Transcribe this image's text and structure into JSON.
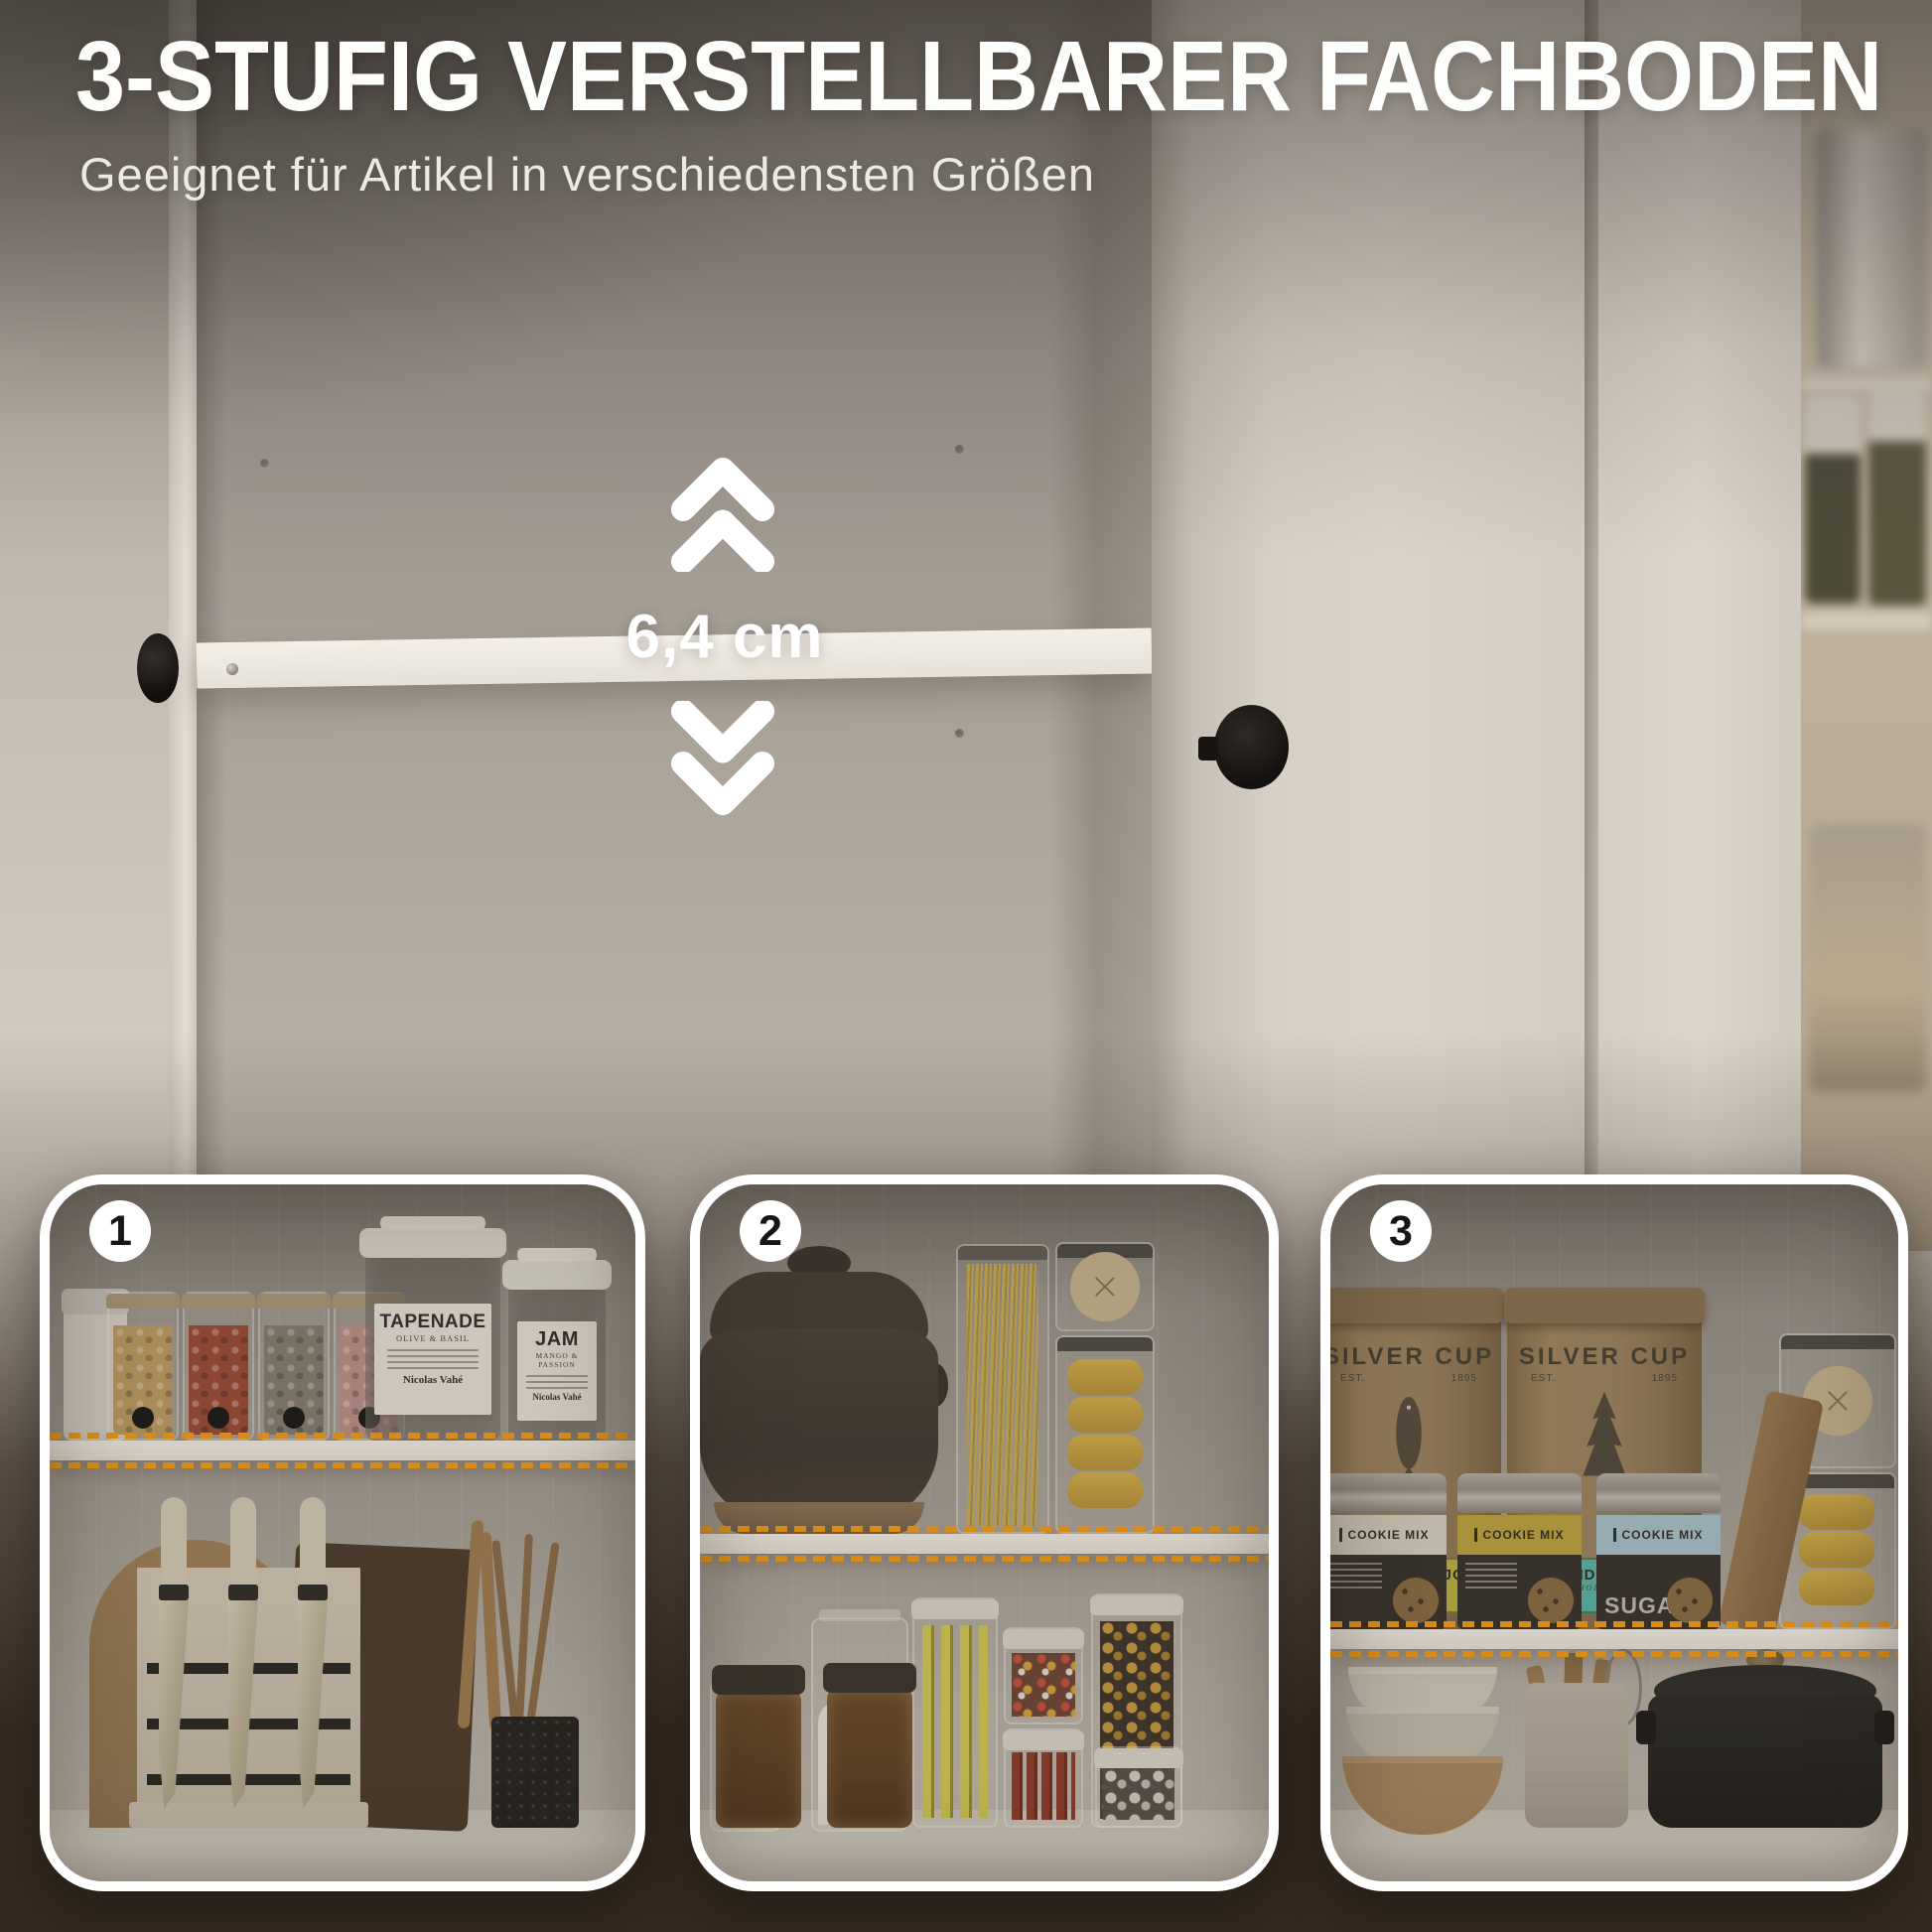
{
  "header": {
    "title": "3-STUFIG VERSTELLBARER FACHBODEN",
    "subtitle": "Geeignet für Artikel in verschiedensten Größen"
  },
  "measurement": {
    "label": "6,4 cm"
  },
  "panels": [
    {
      "number": "1",
      "jars": {
        "tapenade": {
          "title": "TAPENADE",
          "subtitle": "OLIVE & BASIL",
          "brand": "Nicolas Vahé"
        },
        "jam": {
          "title": "JAM",
          "subtitle": "MANGO & PASSION",
          "brand": "Nicolas Vahé"
        }
      }
    },
    {
      "number": "2",
      "jars": {
        "flour": {
          "title": "flour ;"
        }
      }
    },
    {
      "number": "3",
      "bags": [
        {
          "brand": "SILVER CUP",
          "est": "EST.",
          "year": "1895",
          "name": "SNOHO MOJO",
          "grind": "COARSE GRIND"
        },
        {
          "brand": "SILVER CUP",
          "est": "EST.",
          "year": "1895",
          "name": "WONDERLAND",
          "grind": "WHOLE BEAN"
        }
      ],
      "tins": [
        {
          "label": "COOKIE MIX"
        },
        {
          "label": "COOKIE MIX"
        },
        {
          "label": "COOKIE MIX",
          "side": "SUGAR"
        }
      ]
    }
  ],
  "colors": {
    "accent_orange": "#F59B15",
    "shelf_white": "#F2ECE2",
    "panel_border": "#FFFFFF",
    "background_dark": "#352A20",
    "bag_label_yellow": "#B9B23F",
    "bag_label_teal": "#57B5AA"
  }
}
